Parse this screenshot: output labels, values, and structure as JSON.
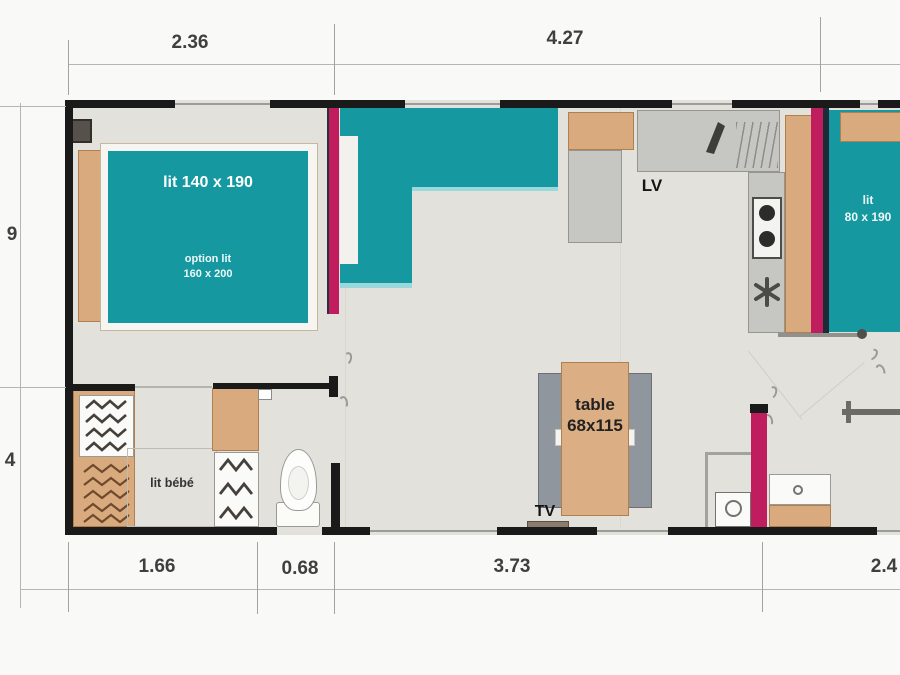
{
  "dimensions": {
    "top": [
      "2.36",
      "4.27"
    ],
    "bottom": [
      "1.66",
      "0.68",
      "3.73",
      "2.4"
    ],
    "left": [
      "9",
      "4"
    ]
  },
  "rooms": {
    "master_bedroom": {
      "bed_label": "lit 140 x 190",
      "bed_option_line1": "option lit",
      "bed_option_line2": "160 x 200"
    },
    "second_bedroom": {
      "bed_label_line1": "lit",
      "bed_label_line2": "80 x 190"
    },
    "kitchen": {
      "dishwasher_label": "LV"
    },
    "living": {
      "table_line1": "table",
      "table_line2": "68x115",
      "tv_label": "TV"
    },
    "dressing": {
      "baby_bed_label": "lit bébé"
    }
  },
  "colors": {
    "teal_furniture": "#1598a0",
    "magenta_doors": "#bf1d5e",
    "wood": "#d9aa7e",
    "wall": "#1a1a1a",
    "floor": "#e2e1dc",
    "bench_gray": "#8f969d"
  }
}
